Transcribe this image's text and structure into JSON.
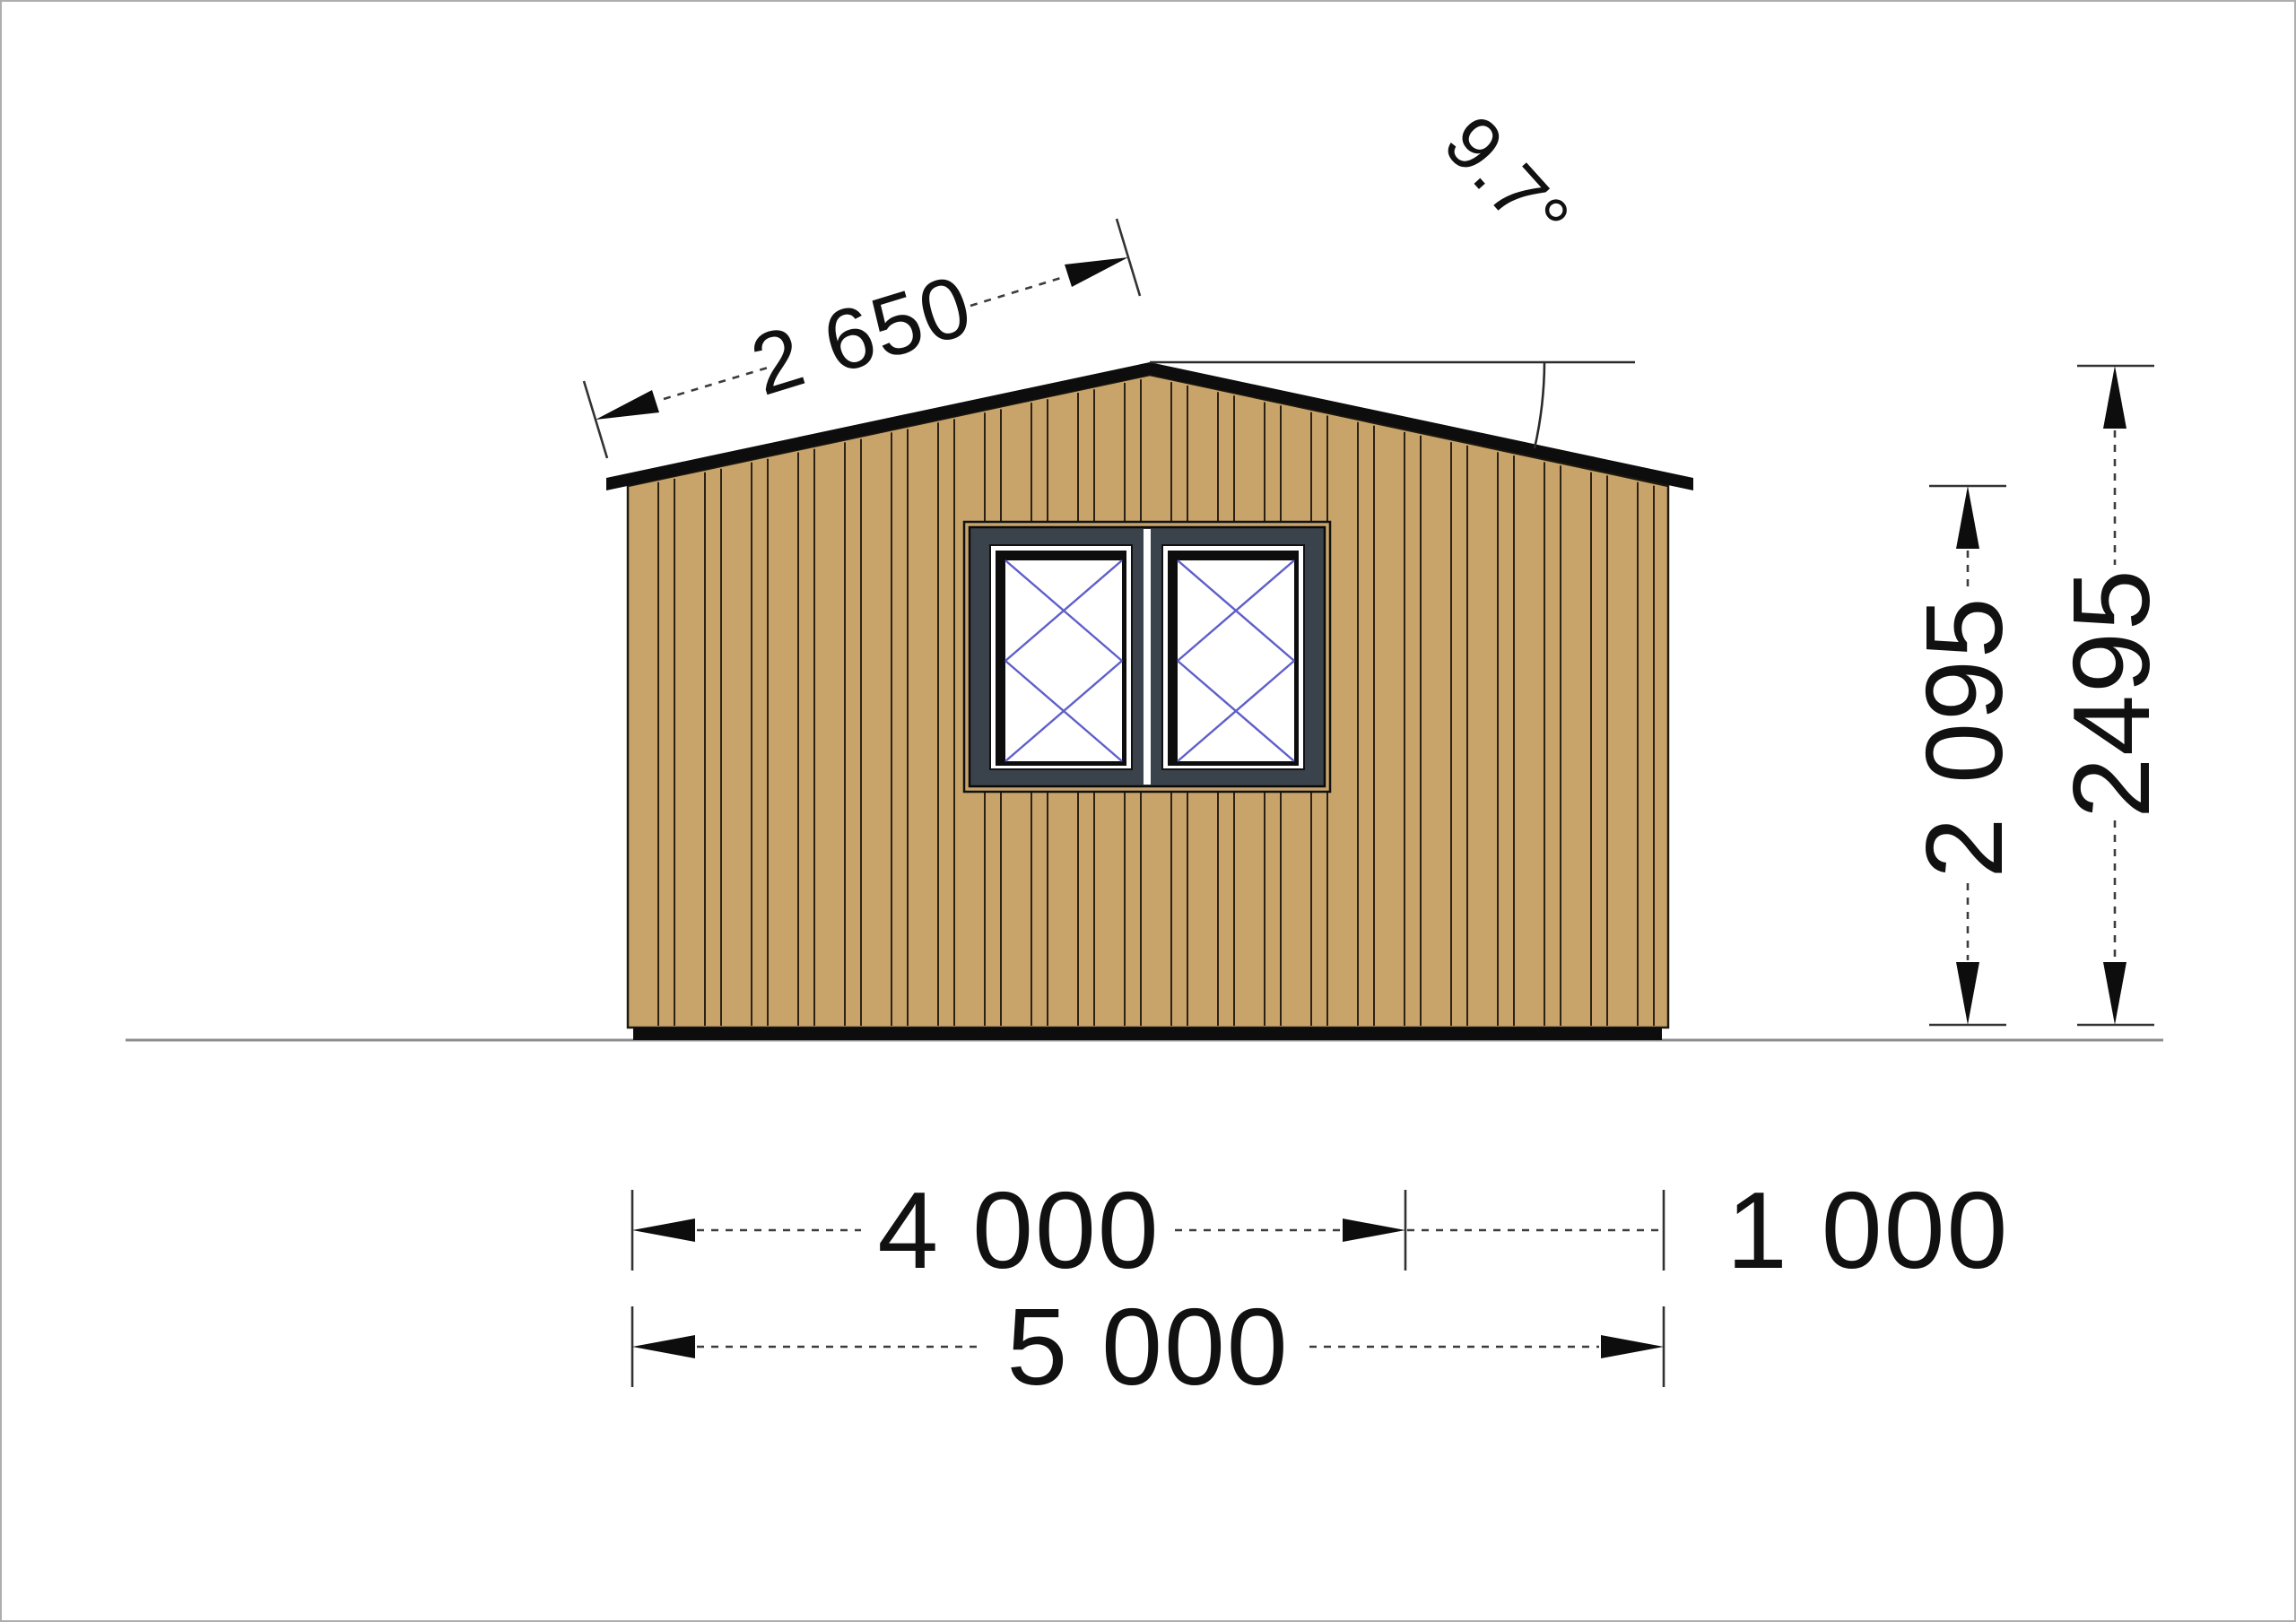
{
  "drawing": {
    "dimensions": {
      "roof_slope_length": "2 650",
      "roof_angle": "9.7°",
      "eave_wall_height": "2 095",
      "ridge_height": "2495",
      "house_width": "4 000",
      "side_extension_width": "1 000",
      "total_width": "5 000"
    },
    "colors": {
      "background": "#ffffff",
      "wall_siding": "#c8a46a",
      "siding_line": "#2b2115",
      "roof": "#0d0d0d",
      "plinth": "#0d0d0d",
      "window_trim": "#c8a46a",
      "window_frame": "#3a434b",
      "window_shadow": "#0d0d0d",
      "sash": "#ffffff",
      "glass": "#ffffff",
      "opening_lines": "#5f5fca",
      "ground_line": "#8c8c8c",
      "dimension_lines": "#333333"
    }
  }
}
